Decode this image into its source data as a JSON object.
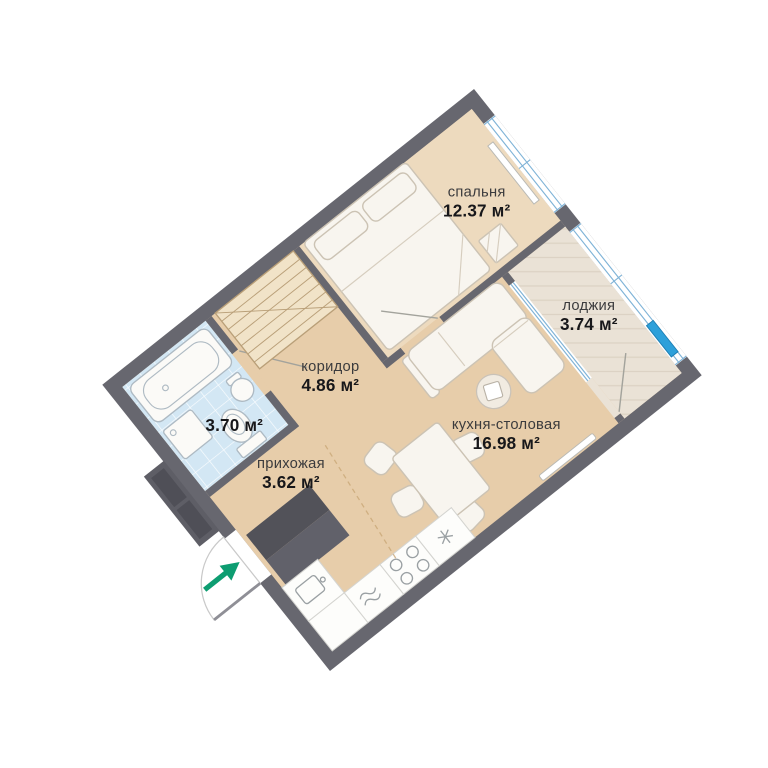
{
  "plan": {
    "title": "apartment-floor-plan",
    "rotation_deg": -38.5,
    "rooms": {
      "bedroom": {
        "name": "спальня",
        "area": "12.37 м²"
      },
      "loggia": {
        "name": "лоджия",
        "area": "3.74 м²"
      },
      "corridor": {
        "name": "коридор",
        "area": "4.86 м²"
      },
      "bathroom": {
        "area": "3.70 м²"
      },
      "kitchen": {
        "name": "кухня-столовая",
        "area": "16.98 м²"
      },
      "hallway": {
        "name": "прихожая",
        "area": "3.62 м²"
      }
    },
    "colors": {
      "wall": "#67676f",
      "floor_main": "#e7cdaa",
      "floor_bedroom": "#eddabe",
      "floor_loggia": "#eae2d6",
      "floor_bathroom_tile": "#d3e7f4",
      "window_frame": "#7fb3d7",
      "window_sash": "#2da0da",
      "entry_arrow": "#0d9d71",
      "wardrobe_dark": "#57575f"
    },
    "furniture": [
      "bathtub",
      "washing-machine",
      "toilet",
      "round-sink",
      "closet-shelves",
      "double-bed",
      "pillows",
      "bedside-stool",
      "corner-sofa",
      "plant-table",
      "dining-table",
      "chairs",
      "kitchen-sink",
      "dishwasher",
      "stove",
      "fridge",
      "hall-wardrobe",
      "radiator",
      "entry-door-swing",
      "entry-arrow"
    ]
  }
}
